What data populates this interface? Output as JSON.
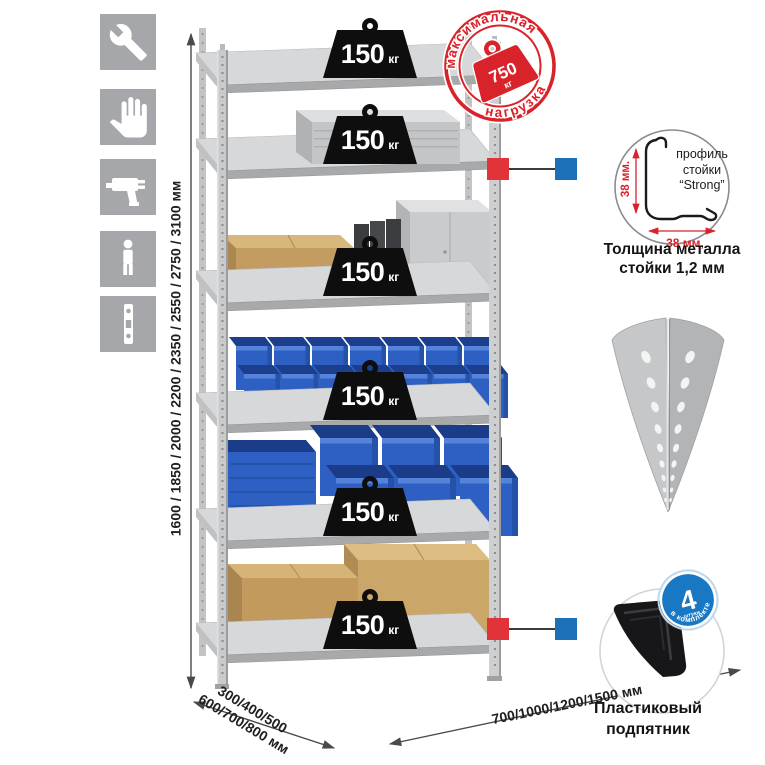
{
  "colors": {
    "stamp_red": "#d8232a",
    "callout_red": "#e13338",
    "callout_blue": "#1c70b8",
    "badge_blue": "#1878c4",
    "icon_gray": "#a6a7ab",
    "bin_blue": "#2e60c4",
    "box_tan": "#c49e63",
    "metal_gray": "#c9cbcd"
  },
  "left_icons": [
    "wrench-icon",
    "gloves-icon",
    "drill-icon",
    "person-height-icon",
    "perforated-profile-icon"
  ],
  "weight_badge": {
    "value": "150",
    "unit": "кг"
  },
  "stamp": {
    "arc_top": "максимальная",
    "arc_bottom": "нагрузка",
    "value": "750",
    "unit": "кг"
  },
  "dimensions": {
    "height": "1600 / 1850 / 2000 / 2200 / 2350 / 2550 / 2750 / 3100 мм",
    "depth_line1": "300/400/500",
    "depth_line2": "600/700/800 мм",
    "width": "700/1000/1200/1500 мм"
  },
  "profile_detail": {
    "line1": "профиль",
    "line2": "стойки",
    "line3": "“Strong”",
    "dim_vertical": "38 мм.",
    "dim_horizontal": "38 мм,",
    "caption_line1": "Толщина металла",
    "caption_line2": "стойки 1,2 мм"
  },
  "foot_detail": {
    "badge_number": "4",
    "badge_units": "штуки",
    "badge_arc": "в комплекте",
    "caption_line1": "Пластиковый",
    "caption_line2": "подпятник"
  }
}
